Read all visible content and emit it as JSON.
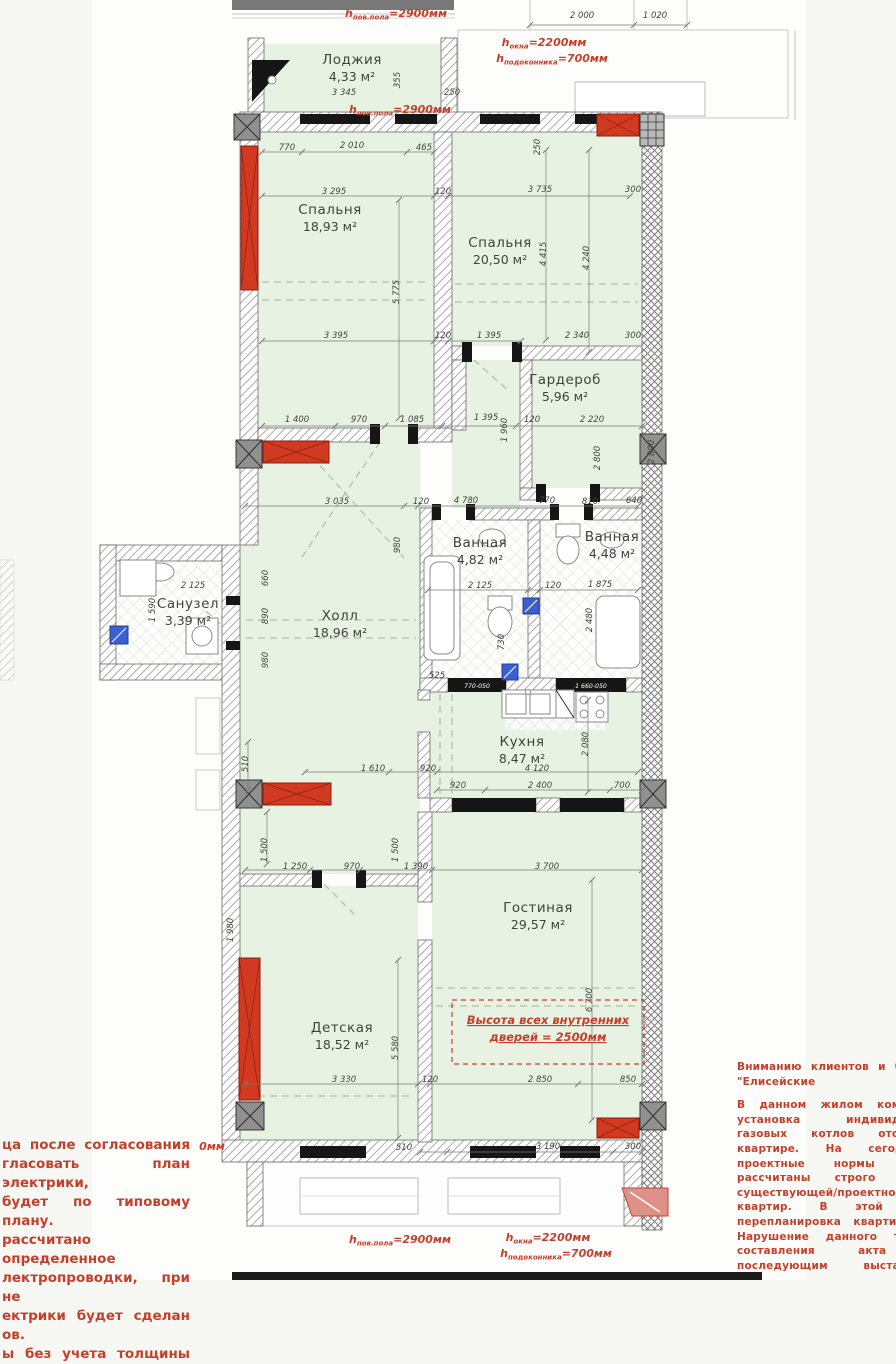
{
  "colors": {
    "room_fill": "#e7f2e2",
    "red_pier": "#d13a20",
    "annotation_red": "#c5402b",
    "blue_box": "#3c5fd0",
    "wall_gray": "#8e8e8e",
    "black": "#161616",
    "dim_text": "#41453c",
    "label_text": "#3e443c",
    "salmon": "#dd9187"
  },
  "rooms": [
    {
      "name": "Лоджия",
      "area": "4,33 м²",
      "x": 352,
      "y": 64
    },
    {
      "name": "Спальня",
      "area": "18,93 м²",
      "x": 330,
      "y": 214
    },
    {
      "name": "Спальня",
      "area": "20,50 м²",
      "x": 500,
      "y": 247
    },
    {
      "name": "Гардероб",
      "area": "5,96 м²",
      "x": 565,
      "y": 384
    },
    {
      "name": "Ванная",
      "area": "4,82 м²",
      "x": 480,
      "y": 547
    },
    {
      "name": "Ванная",
      "area": "4,48 м²",
      "x": 612,
      "y": 541
    },
    {
      "name": "Санузел",
      "area": "3,39 м²",
      "x": 188,
      "y": 608
    },
    {
      "name": "Холл",
      "area": "18,96 м²",
      "x": 340,
      "y": 620
    },
    {
      "name": "Кухня",
      "area": "8,47 м²",
      "x": 522,
      "y": 746
    },
    {
      "name": "Гостиная",
      "area": "29,57 м²",
      "x": 538,
      "y": 912
    },
    {
      "name": "Детская",
      "area": "18,52 м²",
      "x": 342,
      "y": 1032
    }
  ],
  "dims": [
    [
      "2 000",
      582,
      18,
      0
    ],
    [
      "1 020",
      655,
      18,
      0
    ],
    [
      "3 345",
      344,
      95,
      0
    ],
    [
      "355",
      400,
      80,
      1
    ],
    [
      "250",
      452,
      95,
      0
    ],
    [
      "770",
      287,
      150,
      0
    ],
    [
      "2 010",
      352,
      148,
      0
    ],
    [
      "465",
      424,
      150,
      0
    ],
    [
      "250",
      540,
      147,
      1
    ],
    [
      "3 295",
      334,
      194,
      0
    ],
    [
      "120",
      443,
      194,
      0
    ],
    [
      "3 735",
      540,
      192,
      0
    ],
    [
      "300",
      633,
      192,
      0
    ],
    [
      "5 775",
      399,
      292,
      1
    ],
    [
      "4 415",
      546,
      254,
      1
    ],
    [
      "4 240",
      589,
      258,
      1
    ],
    [
      "3 395",
      336,
      338,
      0
    ],
    [
      "120",
      443,
      338,
      0
    ],
    [
      "1 395",
      489,
      338,
      0
    ],
    [
      "2 340",
      577,
      338,
      0
    ],
    [
      "300",
      633,
      338,
      0
    ],
    [
      "1 400",
      297,
      422,
      0
    ],
    [
      "970",
      359,
      422,
      0
    ],
    [
      "1 085",
      412,
      422,
      0
    ],
    [
      "1 395",
      486,
      420,
      0
    ],
    [
      "1 960",
      507,
      430,
      1
    ],
    [
      "120",
      532,
      422,
      0
    ],
    [
      "2 220",
      592,
      422,
      0
    ],
    [
      "2 800",
      600,
      458,
      1
    ],
    [
      "2 800",
      654,
      452,
      1
    ],
    [
      "3 035",
      337,
      504,
      0
    ],
    [
      "120",
      421,
      504,
      0
    ],
    [
      "4 780",
      466,
      503,
      0
    ],
    [
      "770",
      547,
      503,
      0
    ],
    [
      "810",
      590,
      504,
      0
    ],
    [
      "640",
      634,
      503,
      0
    ],
    [
      "980",
      400,
      545,
      1
    ],
    [
      "2 125",
      193,
      588,
      0
    ],
    [
      "1 590",
      155,
      610,
      1
    ],
    [
      "660",
      268,
      578,
      1
    ],
    [
      "890",
      268,
      616,
      1
    ],
    [
      "980",
      268,
      660,
      1
    ],
    [
      "2 125",
      480,
      588,
      0
    ],
    [
      "120",
      553,
      588,
      0
    ],
    [
      "1 875",
      600,
      587,
      0
    ],
    [
      "2 480",
      592,
      620,
      1
    ],
    [
      "730",
      504,
      642,
      1
    ],
    [
      "525",
      437,
      678,
      0
    ],
    [
      "1 610",
      373,
      771,
      0
    ],
    [
      "920",
      428,
      771,
      0
    ],
    [
      "4 120",
      537,
      771,
      0
    ],
    [
      "920",
      458,
      788,
      0
    ],
    [
      "2 400",
      540,
      788,
      0
    ],
    [
      "700",
      622,
      788,
      0
    ],
    [
      "2 080",
      588,
      744,
      1
    ],
    [
      "510",
      248,
      764,
      1
    ],
    [
      "1 500",
      267,
      850,
      1
    ],
    [
      "1 500",
      398,
      850,
      1
    ],
    [
      "1 250",
      295,
      869,
      0
    ],
    [
      "970",
      352,
      869,
      0
    ],
    [
      "1 390",
      416,
      869,
      0
    ],
    [
      "3 700",
      547,
      869,
      0
    ],
    [
      "1 980",
      233,
      930,
      1
    ],
    [
      "6 700",
      592,
      1000,
      1
    ],
    [
      "5 580",
      398,
      1048,
      1
    ],
    [
      "3 330",
      344,
      1082,
      0
    ],
    [
      "120",
      430,
      1082,
      0
    ],
    [
      "2 850",
      540,
      1082,
      0
    ],
    [
      "850",
      628,
      1082,
      0
    ],
    [
      "510",
      404,
      1150,
      0
    ],
    [
      "3 190",
      548,
      1149,
      0
    ],
    [
      "300",
      633,
      1149,
      0
    ]
  ],
  "door_labels": [
    [
      "770-050",
      477,
      688
    ],
    [
      "1 660-050",
      591,
      688
    ]
  ],
  "h_notes": [
    {
      "sub": "пов.пола",
      "val": "2900мм",
      "x": 396,
      "y": 17
    },
    {
      "sub": "пов.пола",
      "val": "2900мм",
      "x": 400,
      "y": 113
    },
    {
      "sub": "окна",
      "val": "2200мм",
      "x": 544,
      "y": 46
    },
    {
      "sub": "подоконника",
      "val": "700мм",
      "x": 552,
      "y": 62
    },
    {
      "sub": "пов.пола",
      "val": "2900мм",
      "x": 400,
      "y": 1243
    },
    {
      "sub": "окна",
      "val": "2200мм",
      "x": 548,
      "y": 1241
    },
    {
      "sub": "подоконника",
      "val": "700мм",
      "x": 556,
      "y": 1257
    }
  ],
  "red_plain": [
    {
      "t": "0мм",
      "x": 212,
      "y": 1150
    }
  ],
  "height_note": {
    "l1": "Высота всех внутренних",
    "l2": "дверей = 2500мм",
    "x": 548,
    "y": 1024
  },
  "left_note": {
    "lines": [
      "ца после согласования",
      "гласовать план электрики,",
      "будет по типовому плану.",
      "рассчитано определенное",
      "лектропроводки, при не",
      "ектрики будет сделан",
      "ов.",
      "ы без учета толщины"
    ]
  },
  "right_note": {
    "title": [
      "Вниманию клиентов и будущ",
      "\"Елисейские поля\"!"
    ],
    "lines": [
      "В данном жилом комплекс",
      "установка индивидуальн",
      "газовых котлов отоплени",
      "квартире. На сегодняшн",
      "проектные нормы газов",
      "рассчитаны строго в с",
      "существующей/проектной",
      "квартир. В этой связ",
      "перепланировка квартир стр",
      "Нарушение данного требов",
      "составления акта о",
      "последующим выставлени"
    ]
  }
}
